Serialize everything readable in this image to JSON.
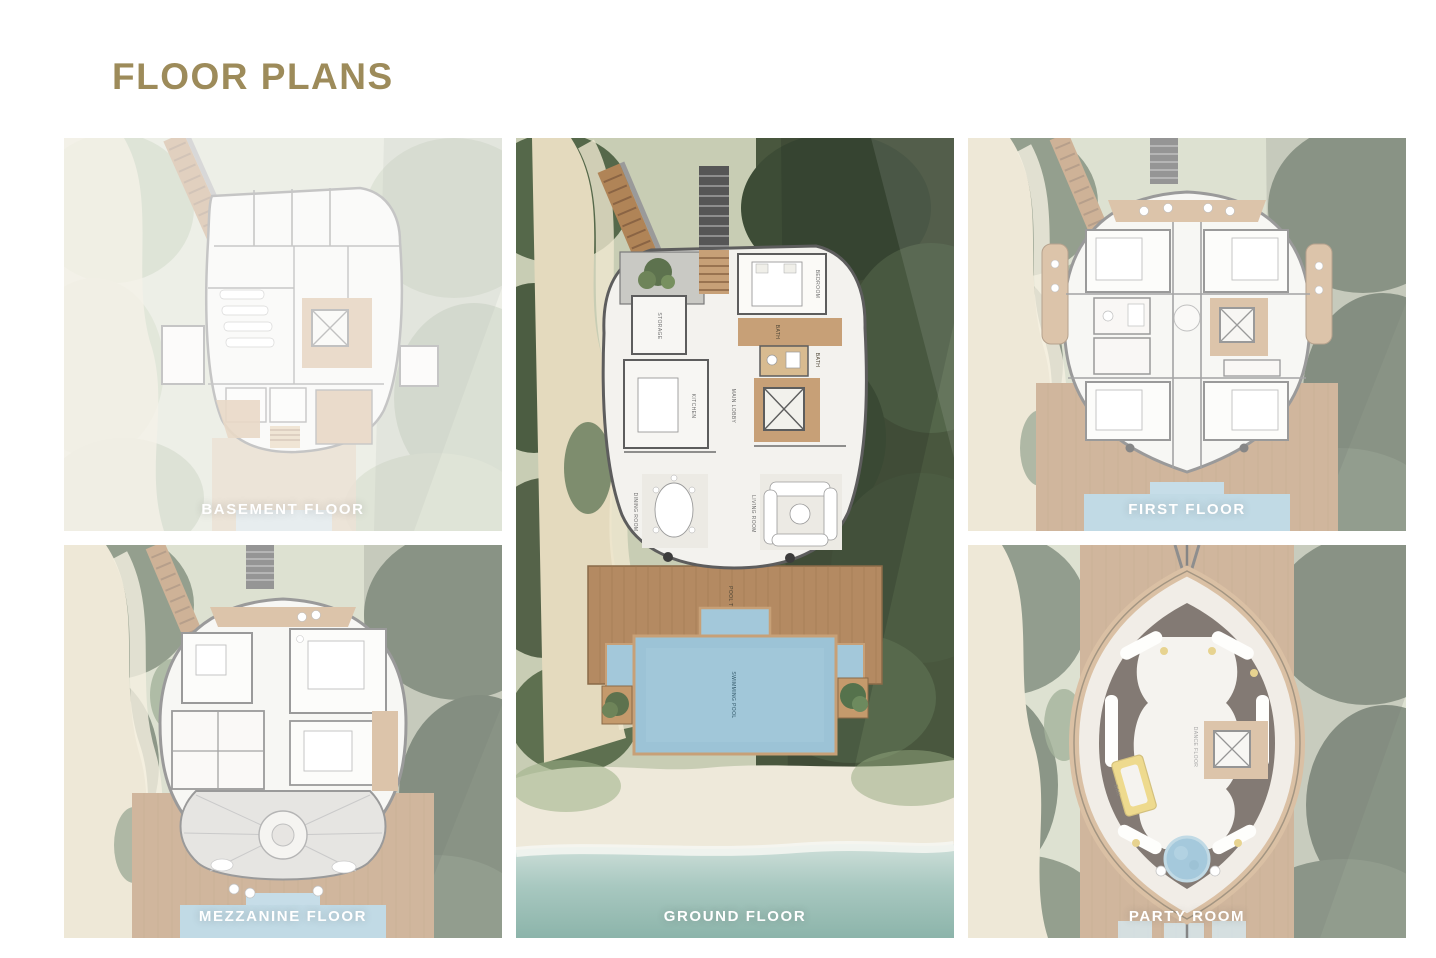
{
  "page": {
    "title": "FLOOR PLANS"
  },
  "theme": {
    "accent_gold": "#9d8b5a",
    "caption_color": "#ffffff",
    "pool_blue": "#9cc3d6",
    "deck_wood": "#b48a62",
    "foliage_green": "#4e5f45",
    "sand": "#e6dcc1",
    "ocean": "#8fb7ad"
  },
  "plans": {
    "basement": {
      "label": "BASEMENT FLOOR"
    },
    "mezzanine": {
      "label": "MEZZANINE FLOOR"
    },
    "ground": {
      "label": "GROUND FLOOR"
    },
    "first": {
      "label": "FIRST FLOOR"
    },
    "party": {
      "label": "PARTY ROOM"
    }
  },
  "rooms": {
    "ground": {
      "storage": "STORAGE",
      "kitchen": "KITCHEN",
      "main_lobby": "MAIN LOBBY",
      "bedroom": "BEDROOM",
      "bath": "BATH",
      "dining_room": "DINING ROOM",
      "living_room": "LIVING ROOM",
      "pool_terrace": "POOL TERRACE",
      "swimming_pool": "SWIMMING POOL"
    },
    "party": {
      "dance_floor": "DANCE FLOOR",
      "bar": "BAR"
    }
  }
}
